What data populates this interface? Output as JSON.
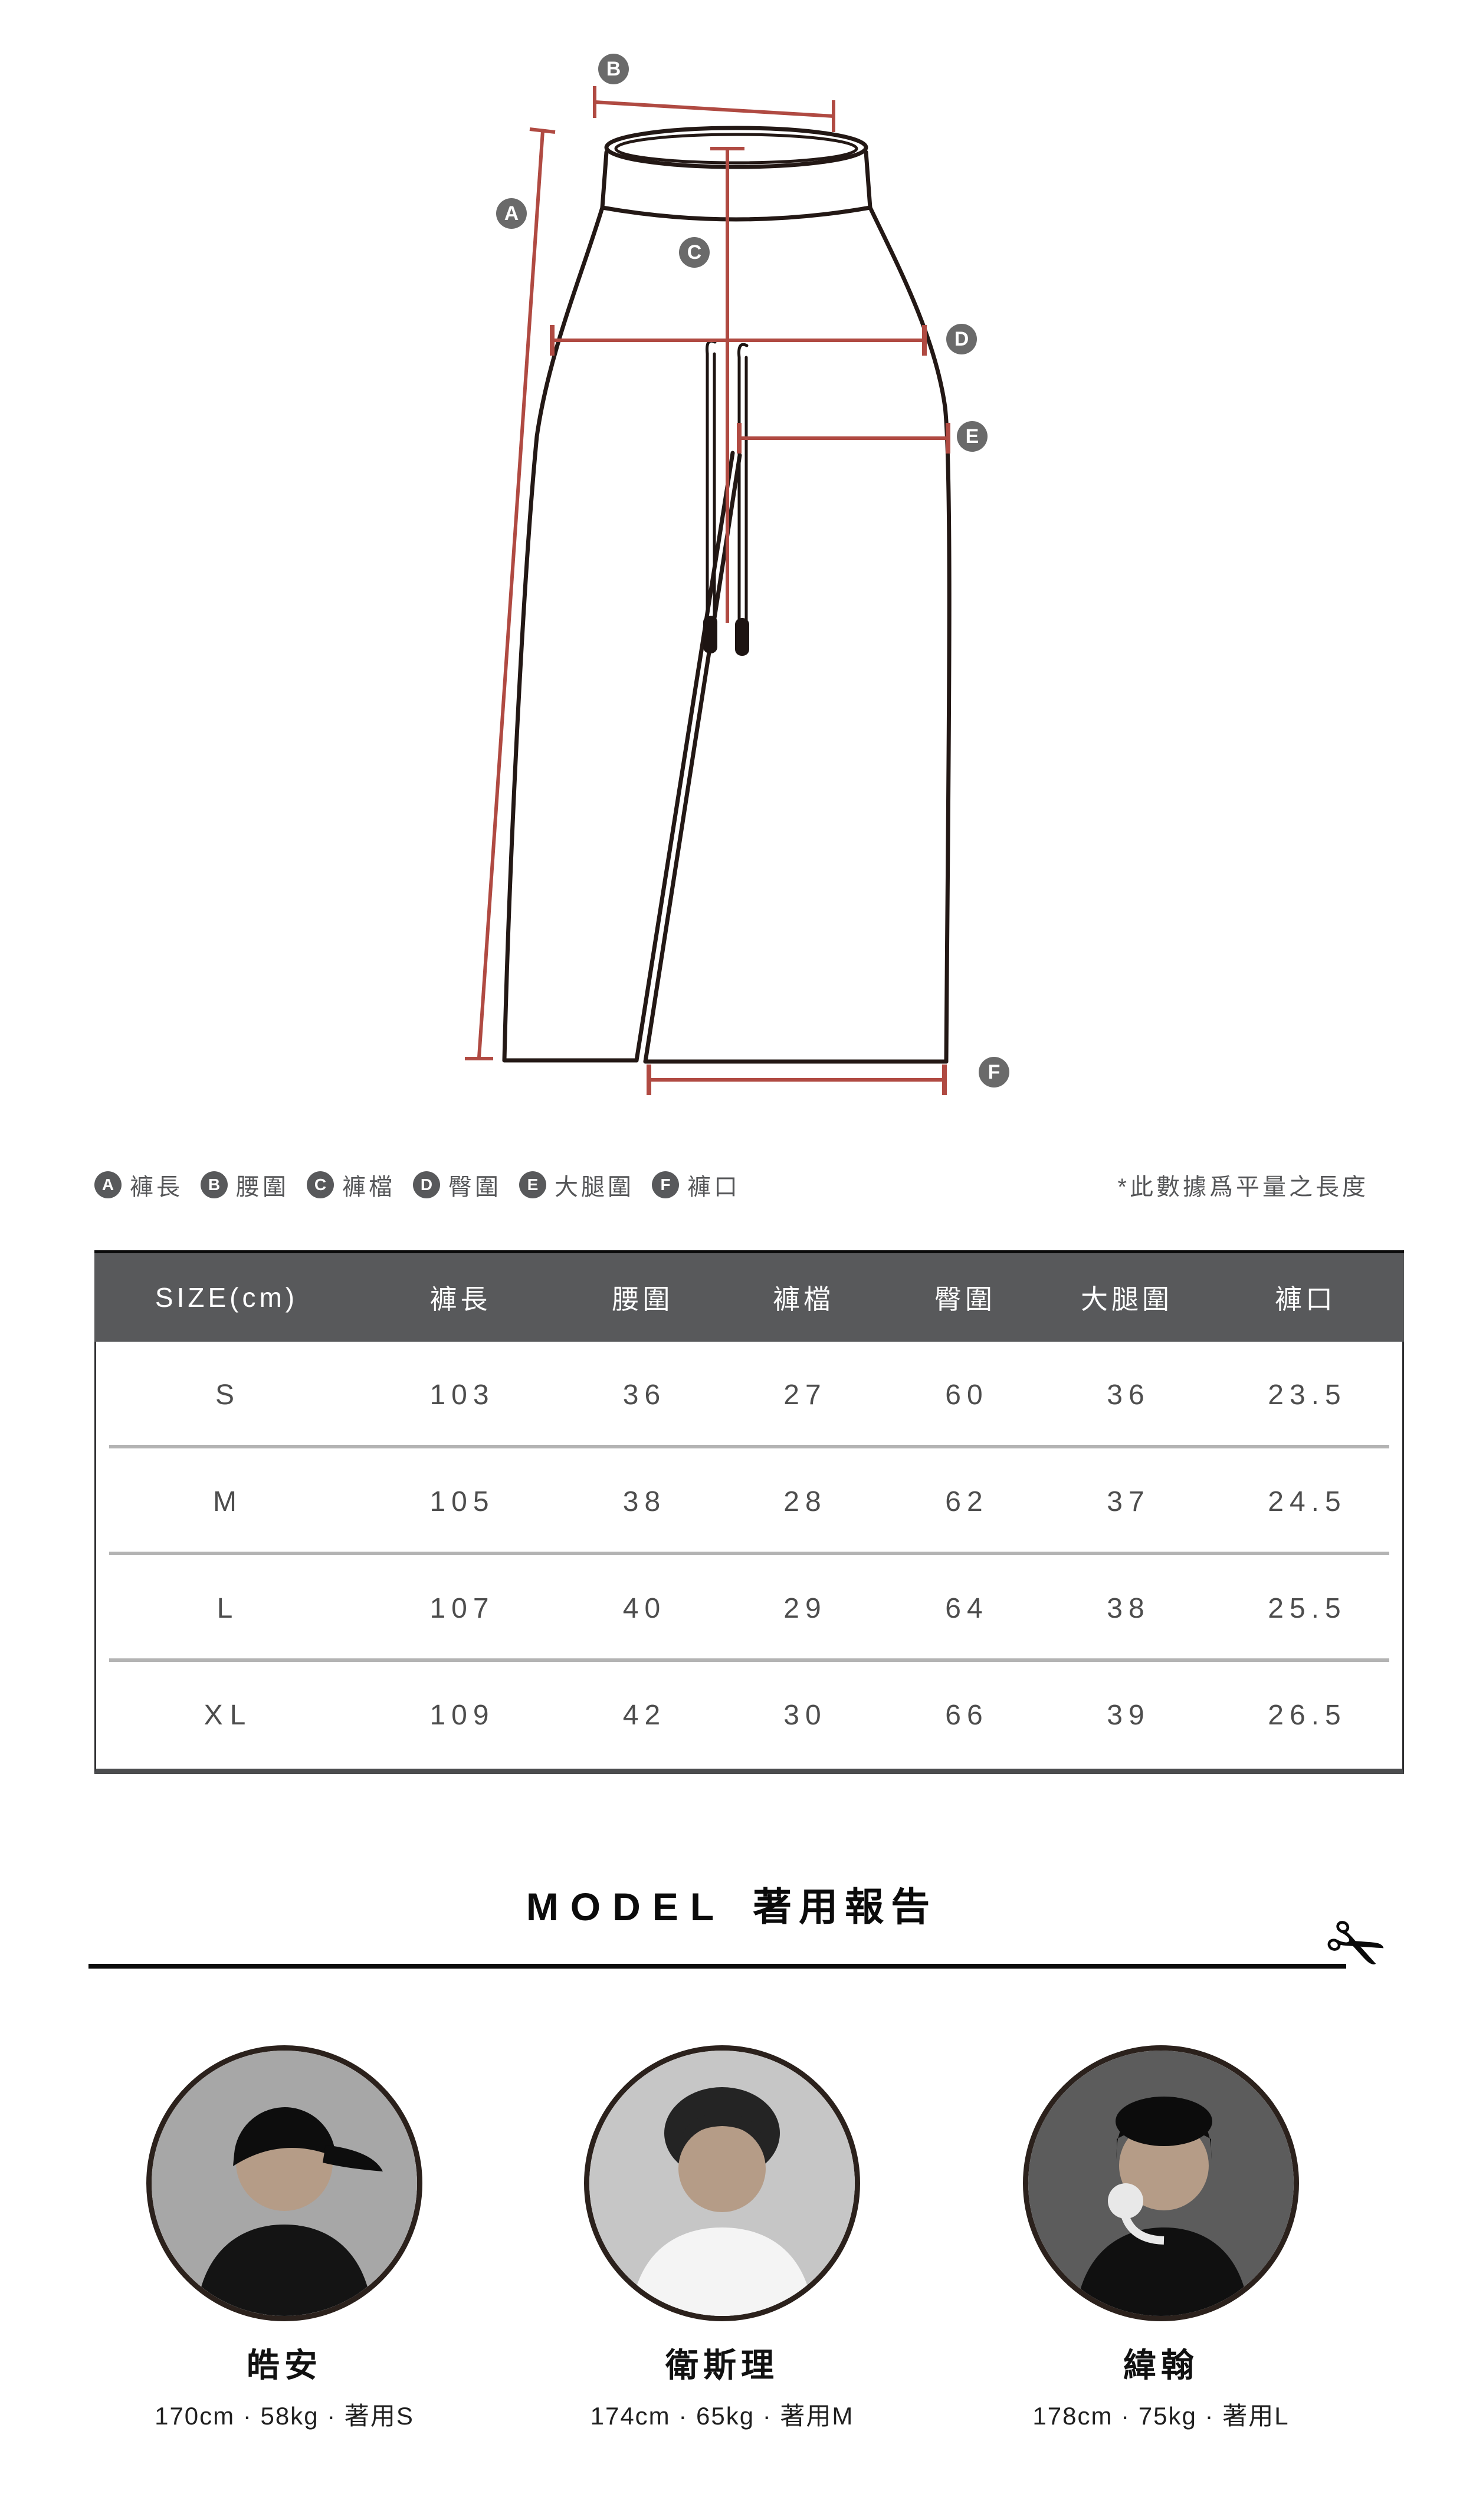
{
  "diagram": {
    "labels": [
      {
        "letter": "A"
      },
      {
        "letter": "B"
      },
      {
        "letter": "C"
      },
      {
        "letter": "D"
      },
      {
        "letter": "E"
      },
      {
        "letter": "F"
      }
    ]
  },
  "legend": {
    "items": [
      {
        "letter": "A",
        "label": "褲長"
      },
      {
        "letter": "B",
        "label": "腰圍"
      },
      {
        "letter": "C",
        "label": "褲檔"
      },
      {
        "letter": "D",
        "label": "臀圍"
      },
      {
        "letter": "E",
        "label": "大腿圍"
      },
      {
        "letter": "F",
        "label": "褲口"
      }
    ],
    "note": "*此數據爲平量之長度"
  },
  "size_chart": {
    "header": [
      "SIZE(cm)",
      "褲長",
      "腰圍",
      "褲檔",
      "臀圍",
      "大腿圍",
      "褲口"
    ],
    "rows": [
      {
        "size": "S",
        "values": [
          "103",
          "36",
          "27",
          "60",
          "36",
          "23.5"
        ]
      },
      {
        "size": "M",
        "values": [
          "105",
          "38",
          "28",
          "62",
          "37",
          "24.5"
        ]
      },
      {
        "size": "L",
        "values": [
          "107",
          "40",
          "29",
          "64",
          "38",
          "25.5"
        ]
      },
      {
        "size": "XL",
        "values": [
          "109",
          "42",
          "30",
          "66",
          "39",
          "26.5"
        ]
      }
    ]
  },
  "model_section": {
    "title_en": "MODEL",
    "title_zh": "著用報告",
    "scissors_icon": "✂",
    "models": [
      {
        "name": "皓安",
        "stats": "170cm · 58kg · 著用S"
      },
      {
        "name": "衛斯理",
        "stats": "174cm · 65kg · 著用M"
      },
      {
        "name": "緯翰",
        "stats": "178cm · 75kg · 著用L"
      }
    ]
  },
  "colors": {
    "measure_line": "#b04a42",
    "outline": "#231815",
    "label_circle": "#6a6a6a",
    "table_header_bg": "#58595b",
    "row_divider": "#b3b3b3"
  }
}
